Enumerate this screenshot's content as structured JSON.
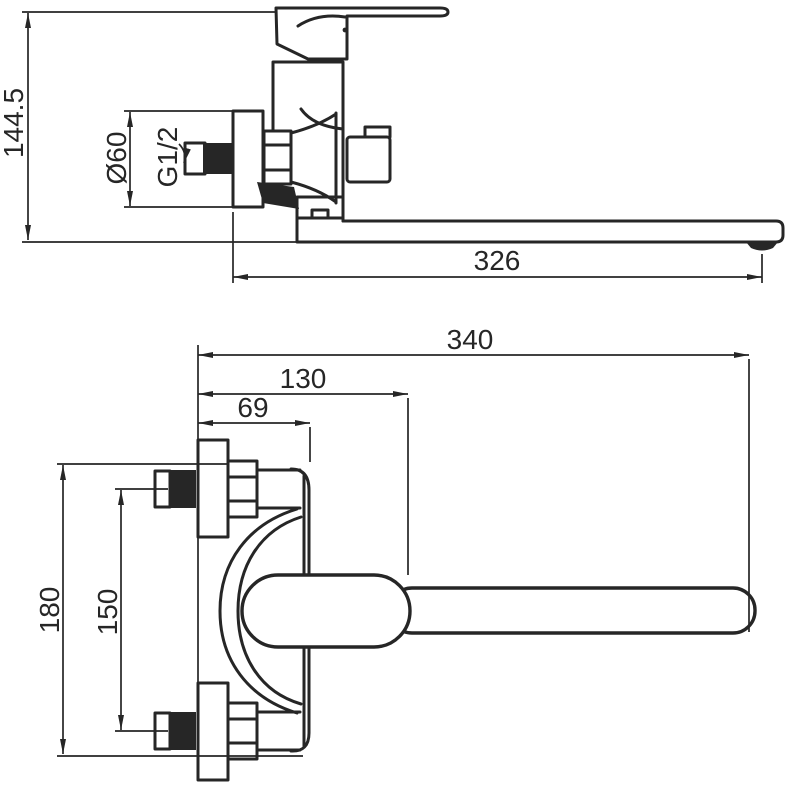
{
  "drawing": {
    "description": "Technical dimension drawing of a wall-mounted single-lever bath mixer with long swivel spout; upper side elevation and lower plan view",
    "colors": {
      "ink": "#262626",
      "background": "#ffffff"
    },
    "side_view": {
      "dims": {
        "height": "144.5",
        "flange_diameter": "Ø60",
        "thread": "G1/2",
        "spout_reach": "326"
      }
    },
    "plan_view": {
      "dims": {
        "overall_length": "340",
        "wall_to_spout_start": "130",
        "wall_to_body": "69",
        "outer_span": "180",
        "inlet_centers": "150"
      }
    }
  }
}
